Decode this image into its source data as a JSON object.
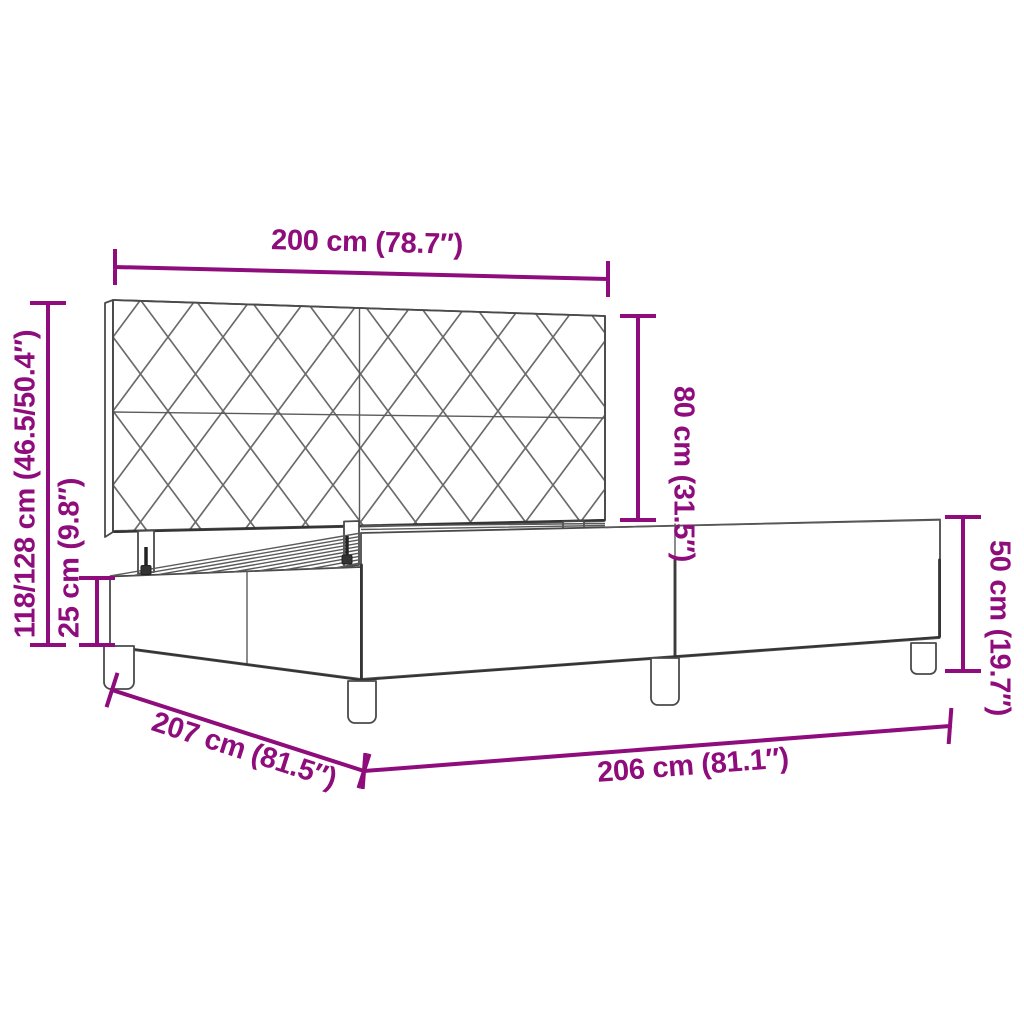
{
  "colors": {
    "accent": "#8E0C7B",
    "line_art": "#4A4A4A",
    "background": "#FFFFFF"
  },
  "diagram": {
    "type": "product-dimension-diagram",
    "product": "bed-frame-with-headboard",
    "dimensions": {
      "headboard_width": {
        "label": "200 cm (78.7″)",
        "cm": "200",
        "inches": "78.7"
      },
      "headboard_height": {
        "label": "80 cm (31.5″)",
        "cm": "80",
        "inches": "31.5"
      },
      "total_height": {
        "label": "118/128 cm (46.5/50.4″)",
        "cm": "118/128",
        "inches": "46.5/50.4"
      },
      "base_height": {
        "label": "25 cm (9.8″)",
        "cm": "25",
        "inches": "9.8"
      },
      "side_rail_height": {
        "label": "50 cm (19.7″)",
        "cm": "50",
        "inches": "19.7"
      },
      "frame_length": {
        "label": "207 cm (81.5″)",
        "cm": "207",
        "inches": "81.5"
      },
      "frame_width": {
        "label": "206 cm (81.1″)",
        "cm": "206",
        "inches": "81.1"
      }
    }
  }
}
